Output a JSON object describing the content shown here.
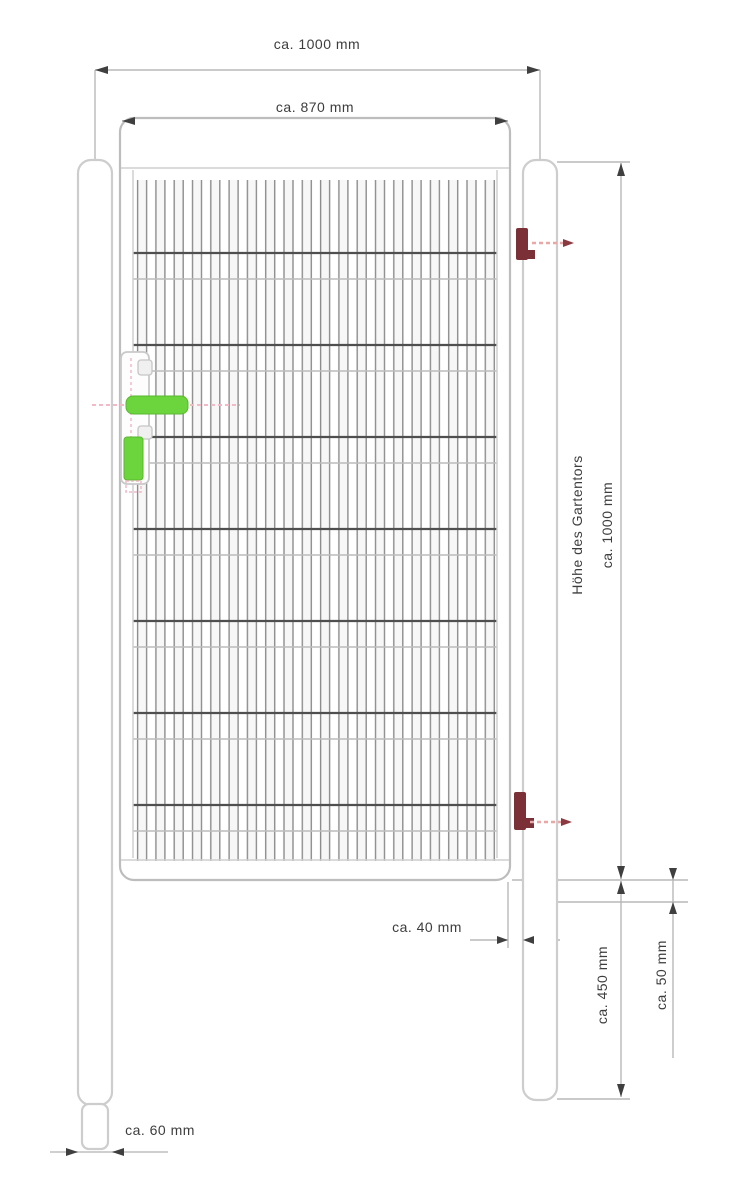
{
  "diagram": {
    "type": "technical-drawing",
    "subject": "garden-gate-with-posts",
    "dimensions": {
      "overall_width": "ca. 1000 mm",
      "frame_width": "ca. 870 mm",
      "gate_height_label": "Höhe des Gartentors",
      "gate_height_value": "ca. 1000 mm",
      "post_below_gate": "ca. 450 mm",
      "ground_clearance": "ca. 50 mm",
      "frame_post_gap": "ca. 40 mm",
      "post_width": "ca. 60 mm"
    },
    "colors": {
      "handle_green": "#6cd43c",
      "hinge_red": "#7b2f36",
      "hinge_arrow_red": "#e9a7a7",
      "lock_axis_pink": "#f2b9c6",
      "outline_gray": "#c6c6c6",
      "mesh_wire_dark": "#4f4f4f",
      "dim_line_gray": "#b8b8b8",
      "dim_text": "#3d3d3d"
    }
  }
}
